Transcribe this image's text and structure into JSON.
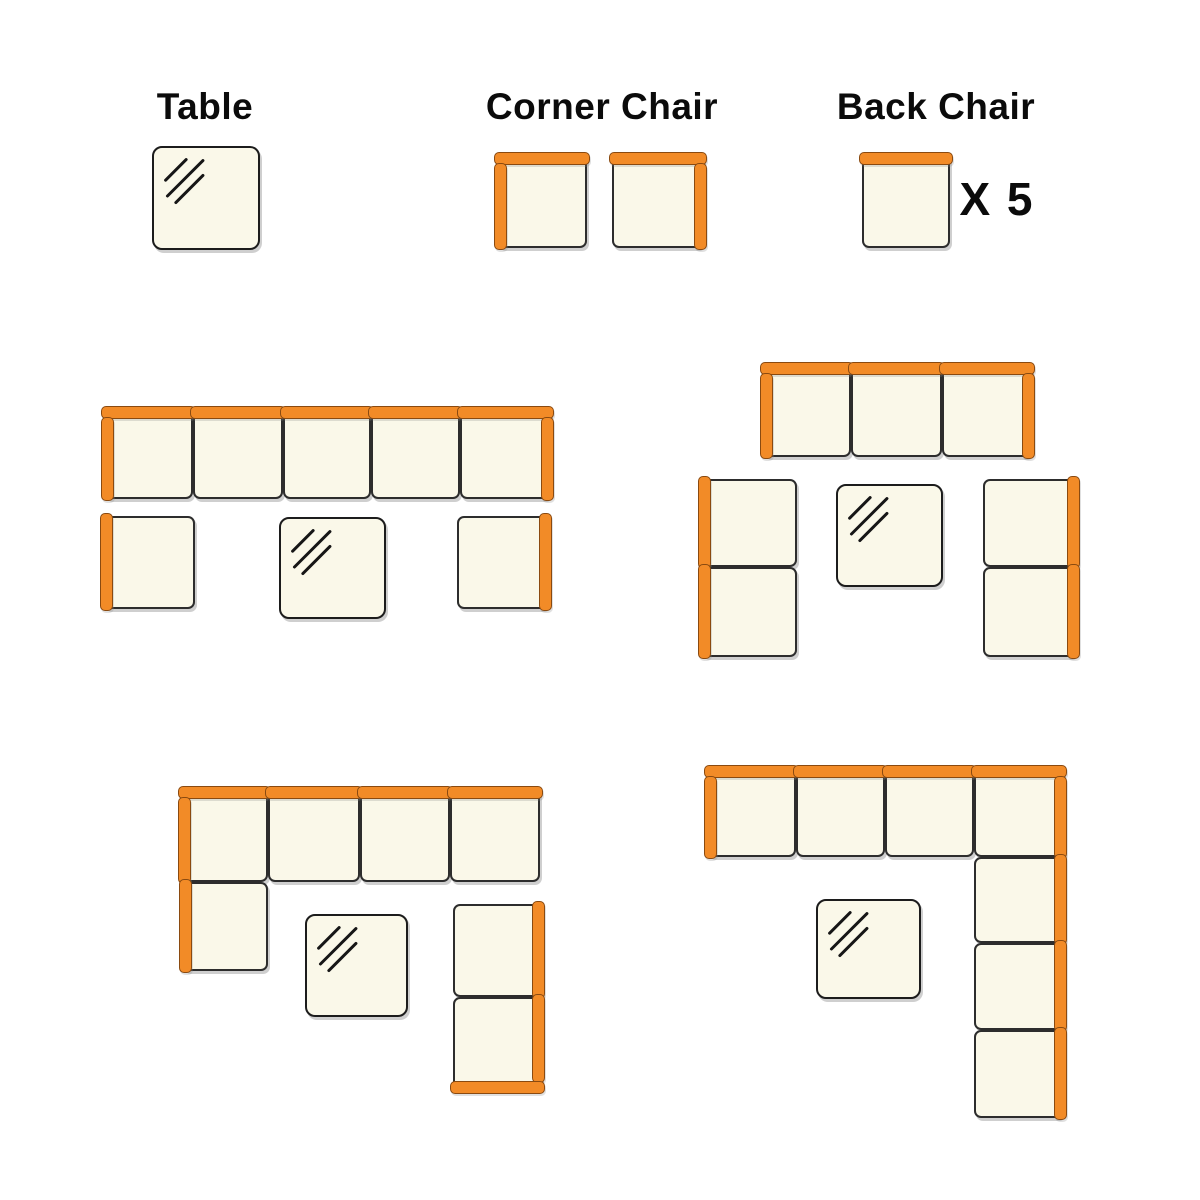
{
  "colors": {
    "background": "#FFFFFF",
    "orange": "#F28B27",
    "orange_border": "#8A4A10",
    "seat_fill": "#FAF8E9",
    "seat_border": "#2D2D2D",
    "table_border": "#1C1C1C",
    "text": "#0B0B0B",
    "shadow": "rgba(135,135,135,0.4)"
  },
  "legend": {
    "table_label": "Table",
    "corner_label": "Corner Chair",
    "back_label": "Back Chair",
    "back_count_label": "X 5"
  },
  "groups": [
    {
      "name": "legend-samples",
      "pieces": [
        {
          "type": "table",
          "bars": [],
          "x": 152,
          "y": 146,
          "w": 108,
          "h": 104
        },
        {
          "type": "corner",
          "bars": [
            "top",
            "left"
          ],
          "x": 497,
          "y": 155,
          "w": 90,
          "h": 93
        },
        {
          "type": "corner",
          "bars": [
            "top",
            "right"
          ],
          "x": 612,
          "y": 155,
          "w": 92,
          "h": 93
        },
        {
          "type": "back",
          "bars": [
            "top"
          ],
          "x": 862,
          "y": 155,
          "w": 88,
          "h": 93
        }
      ]
    },
    {
      "name": "layout-row-with-sides",
      "pieces": [
        {
          "type": "corner",
          "bars": [
            "top",
            "left"
          ],
          "x": 104,
          "y": 409,
          "w": 89,
          "h": 90
        },
        {
          "type": "back",
          "bars": [
            "top"
          ],
          "x": 193,
          "y": 409,
          "w": 90,
          "h": 90
        },
        {
          "type": "back",
          "bars": [
            "top"
          ],
          "x": 283,
          "y": 409,
          "w": 88,
          "h": 90
        },
        {
          "type": "back",
          "bars": [
            "top"
          ],
          "x": 371,
          "y": 409,
          "w": 89,
          "h": 90
        },
        {
          "type": "corner",
          "bars": [
            "top",
            "right"
          ],
          "x": 460,
          "y": 409,
          "w": 91,
          "h": 90
        },
        {
          "type": "back",
          "bars": [
            "left"
          ],
          "x": 103,
          "y": 516,
          "w": 92,
          "h": 93
        },
        {
          "type": "table",
          "bars": [],
          "x": 279,
          "y": 517,
          "w": 107,
          "h": 102
        },
        {
          "type": "back",
          "bars": [
            "right"
          ],
          "x": 457,
          "y": 516,
          "w": 92,
          "h": 93
        }
      ]
    },
    {
      "name": "layout-u-shape",
      "pieces": [
        {
          "type": "corner",
          "bars": [
            "top",
            "left"
          ],
          "x": 763,
          "y": 365,
          "w": 88,
          "h": 92
        },
        {
          "type": "back",
          "bars": [
            "top"
          ],
          "x": 851,
          "y": 365,
          "w": 91,
          "h": 92
        },
        {
          "type": "corner",
          "bars": [
            "top",
            "right"
          ],
          "x": 942,
          "y": 365,
          "w": 90,
          "h": 92
        },
        {
          "type": "back",
          "bars": [
            "left"
          ],
          "x": 701,
          "y": 479,
          "w": 96,
          "h": 88
        },
        {
          "type": "back",
          "bars": [
            "left"
          ],
          "x": 701,
          "y": 567,
          "w": 96,
          "h": 90
        },
        {
          "type": "table",
          "bars": [],
          "x": 836,
          "y": 484,
          "w": 107,
          "h": 103
        },
        {
          "type": "back",
          "bars": [
            "right"
          ],
          "x": 983,
          "y": 479,
          "w": 94,
          "h": 88
        },
        {
          "type": "back",
          "bars": [
            "right"
          ],
          "x": 983,
          "y": 567,
          "w": 94,
          "h": 90
        }
      ]
    },
    {
      "name": "layout-l-shape-left",
      "pieces": [
        {
          "type": "corner",
          "bars": [
            "top",
            "left"
          ],
          "x": 181,
          "y": 789,
          "w": 87,
          "h": 93
        },
        {
          "type": "back",
          "bars": [
            "top"
          ],
          "x": 268,
          "y": 789,
          "w": 92,
          "h": 93
        },
        {
          "type": "back",
          "bars": [
            "top"
          ],
          "x": 360,
          "y": 789,
          "w": 90,
          "h": 93
        },
        {
          "type": "back",
          "bars": [
            "top"
          ],
          "x": 450,
          "y": 789,
          "w": 90,
          "h": 93
        },
        {
          "type": "back",
          "bars": [
            "left"
          ],
          "x": 182,
          "y": 882,
          "w": 86,
          "h": 89
        },
        {
          "type": "table",
          "bars": [],
          "x": 305,
          "y": 914,
          "w": 103,
          "h": 103
        },
        {
          "type": "back",
          "bars": [
            "right"
          ],
          "x": 453,
          "y": 904,
          "w": 89,
          "h": 93
        },
        {
          "type": "corner",
          "bars": [
            "right",
            "bottom"
          ],
          "x": 453,
          "y": 997,
          "w": 89,
          "h": 94
        }
      ]
    },
    {
      "name": "layout-l-shape-right",
      "pieces": [
        {
          "type": "corner",
          "bars": [
            "top",
            "left"
          ],
          "x": 707,
          "y": 768,
          "w": 89,
          "h": 89
        },
        {
          "type": "back",
          "bars": [
            "top"
          ],
          "x": 796,
          "y": 768,
          "w": 89,
          "h": 89
        },
        {
          "type": "back",
          "bars": [
            "top"
          ],
          "x": 885,
          "y": 768,
          "w": 89,
          "h": 89
        },
        {
          "type": "corner",
          "bars": [
            "top",
            "right"
          ],
          "x": 974,
          "y": 768,
          "w": 90,
          "h": 89
        },
        {
          "type": "back",
          "bars": [
            "right"
          ],
          "x": 974,
          "y": 857,
          "w": 90,
          "h": 86
        },
        {
          "type": "back",
          "bars": [
            "right"
          ],
          "x": 974,
          "y": 943,
          "w": 90,
          "h": 87
        },
        {
          "type": "back",
          "bars": [
            "right"
          ],
          "x": 974,
          "y": 1030,
          "w": 90,
          "h": 88
        },
        {
          "type": "table",
          "bars": [],
          "x": 816,
          "y": 899,
          "w": 105,
          "h": 100
        }
      ]
    }
  ]
}
